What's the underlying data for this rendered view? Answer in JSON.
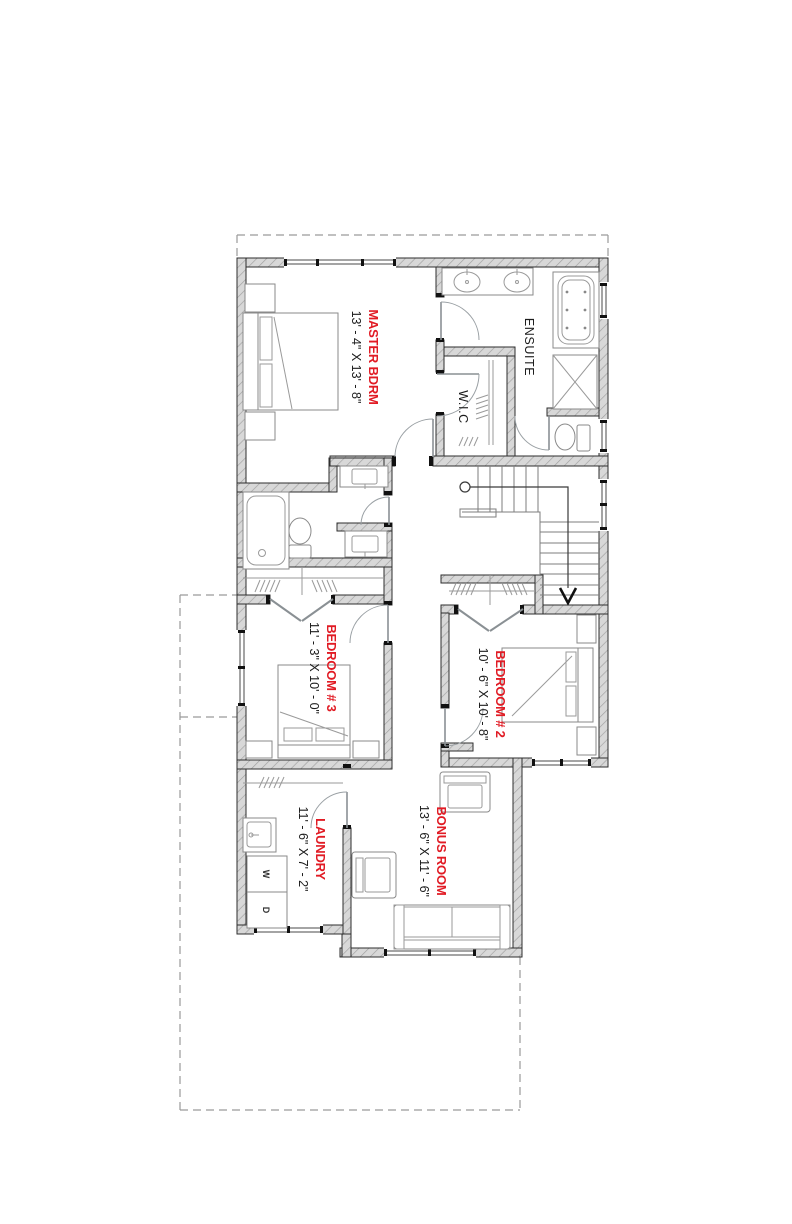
{
  "plan": {
    "title": "upper-floor-plan",
    "rooms": [
      {
        "id": "master",
        "name": "MASTER BDRM",
        "dims": "13' - 4\" X 13' - 8\""
      },
      {
        "id": "ensuite",
        "name": "ENSUITE"
      },
      {
        "id": "wic",
        "name": "W.I.C"
      },
      {
        "id": "bedroom3",
        "name": "BEDROOM # 3",
        "dims": "11' - 3\" X 10' - 0\""
      },
      {
        "id": "bedroom2",
        "name": "BEDROOM # 2",
        "dims": "10' - 6\" X 10' - 8\""
      },
      {
        "id": "laundry",
        "name": "LAUNDRY",
        "dims": "11' - 6\" X 7' - 2\""
      },
      {
        "id": "bonus",
        "name": "BONUS ROOM",
        "dims": "13' - 6\" X 11' - 6\""
      }
    ],
    "appliances": {
      "washer": "W",
      "dryer": "D"
    },
    "icons": {
      "stair_direction": "down-arrow",
      "stair_start": "circle-marker"
    },
    "colors": {
      "room_name": "#e11b24",
      "dim_text": "#1c1c1c",
      "wall_fill": "#d8d8d8",
      "wall_hatch": "#a0a0a0"
    }
  }
}
